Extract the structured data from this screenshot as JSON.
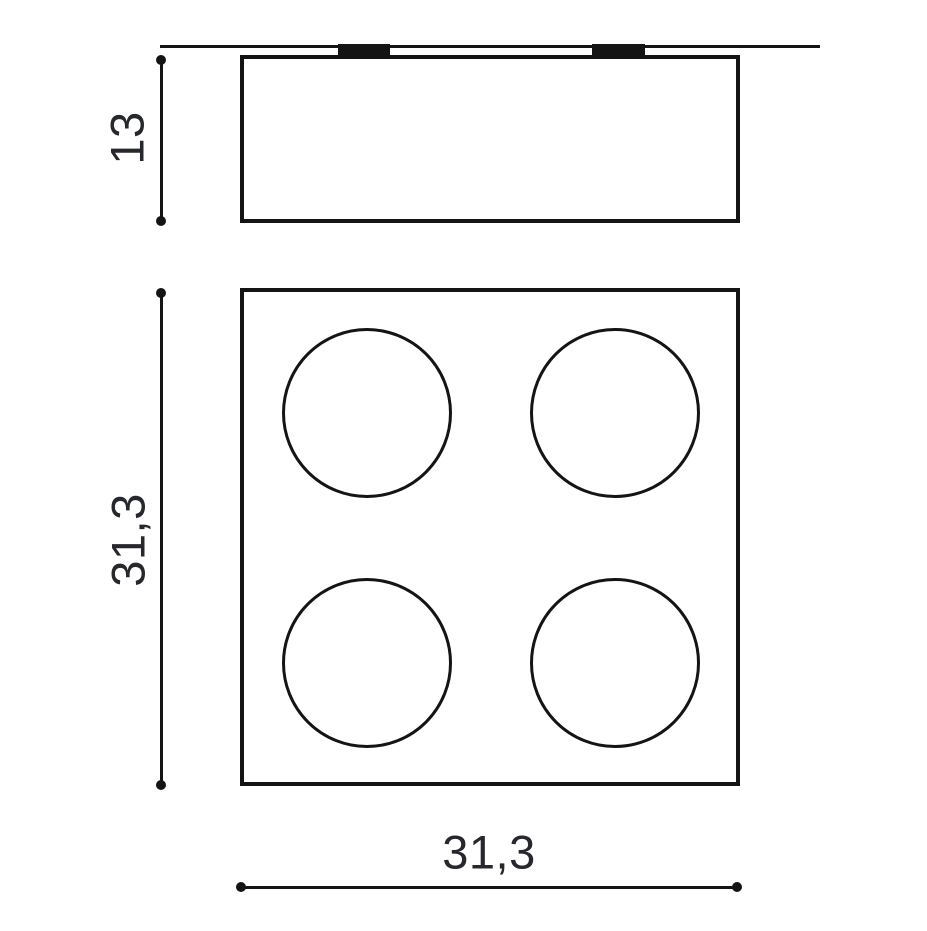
{
  "drawing": {
    "background": "#ffffff",
    "line_color": "#141414",
    "text_color": "#26282e"
  },
  "side_view": {
    "name": "side-elevation",
    "mounting_tabs": 2,
    "height_dim": {
      "label": "13"
    }
  },
  "top_view": {
    "name": "plan-view",
    "spot_count": 4,
    "vertical_dim": {
      "label": "31,3"
    },
    "horizontal_dim": {
      "label": "31,3"
    }
  }
}
